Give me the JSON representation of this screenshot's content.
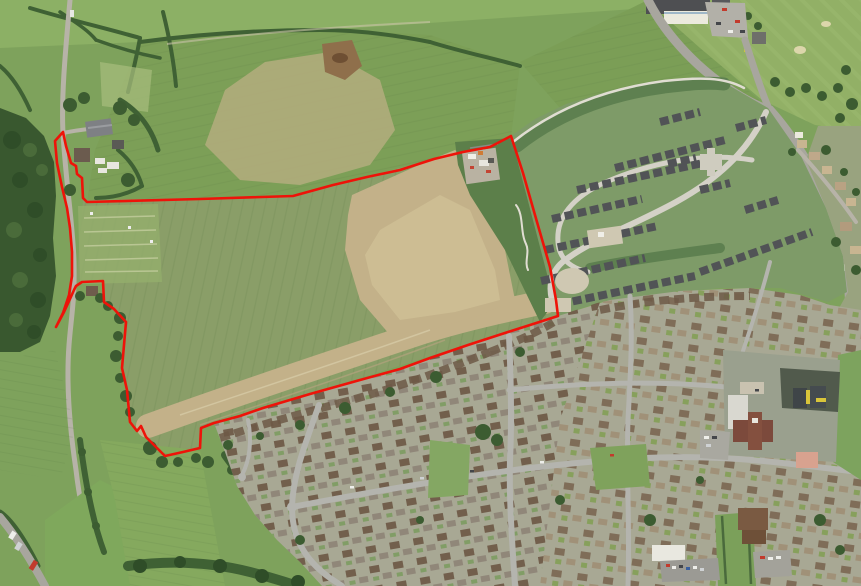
{
  "map": {
    "boundary": {
      "color": "#ee1309",
      "stroke_width": 2.6,
      "points": "63,132 55,141 57,163 62,187 67,208 70,228 72,252 72,276 69,295 63,313 56,327 64,312 70,299 74,290 76,286 82,282 103,281 104,302 114,309 126,322 124,345 122,368 127,390 130,422 137,431 141,426 146,437 165,456 183,452 200,448 201,428 214,423 240,416 263,408 310,394 360,380 400,369 430,358 468,345 508,332 530,325 558,316 556,300 550,267 537,222 523,173 511,136 490,147 463,152 434,159 400,170 367,177 333,185 293,196 200,199 87,202 83,198 82,178 77,174 76,166 71,163 66,146"
    },
    "palette": {
      "baseField": "#7ea25c",
      "lightField": "#8cb065",
      "northField": "#7c9f57",
      "siteField": "#8a9e68",
      "tanSoil": "#c3b189",
      "tanCore": "#cfc096",
      "paleDryPatch": "#b4ad7e",
      "dirtMound": "#8f6f4b",
      "woodland": "#39582f",
      "hedgeGreen": "#3f6134",
      "roughGreen": "#5c7f4a",
      "renderLawn": "#7e9b68",
      "renderBuffer": "#5e8050",
      "renderRoad": "#d4d1c7",
      "renderHouse": "#515356",
      "estateBase": "#a8a894",
      "estateRoad": "#b4b4ae",
      "roofBrown": "#6f5b48",
      "roofGray": "#8f8578",
      "bungalowRoof": "#c8b591",
      "golfGreen": "#92b066",
      "roadAsphalt": "#a8a69e",
      "whiteRoof": "#e9e8e0",
      "schoolTarmac": "#515a4c",
      "schoolYellow": "#d9c53a",
      "maroonRoof": "#7c4a3c",
      "salmonRoof": "#d8a28f",
      "beigePad": "#cfc8b2",
      "allotmentGreen": "#93ad6c"
    }
  }
}
